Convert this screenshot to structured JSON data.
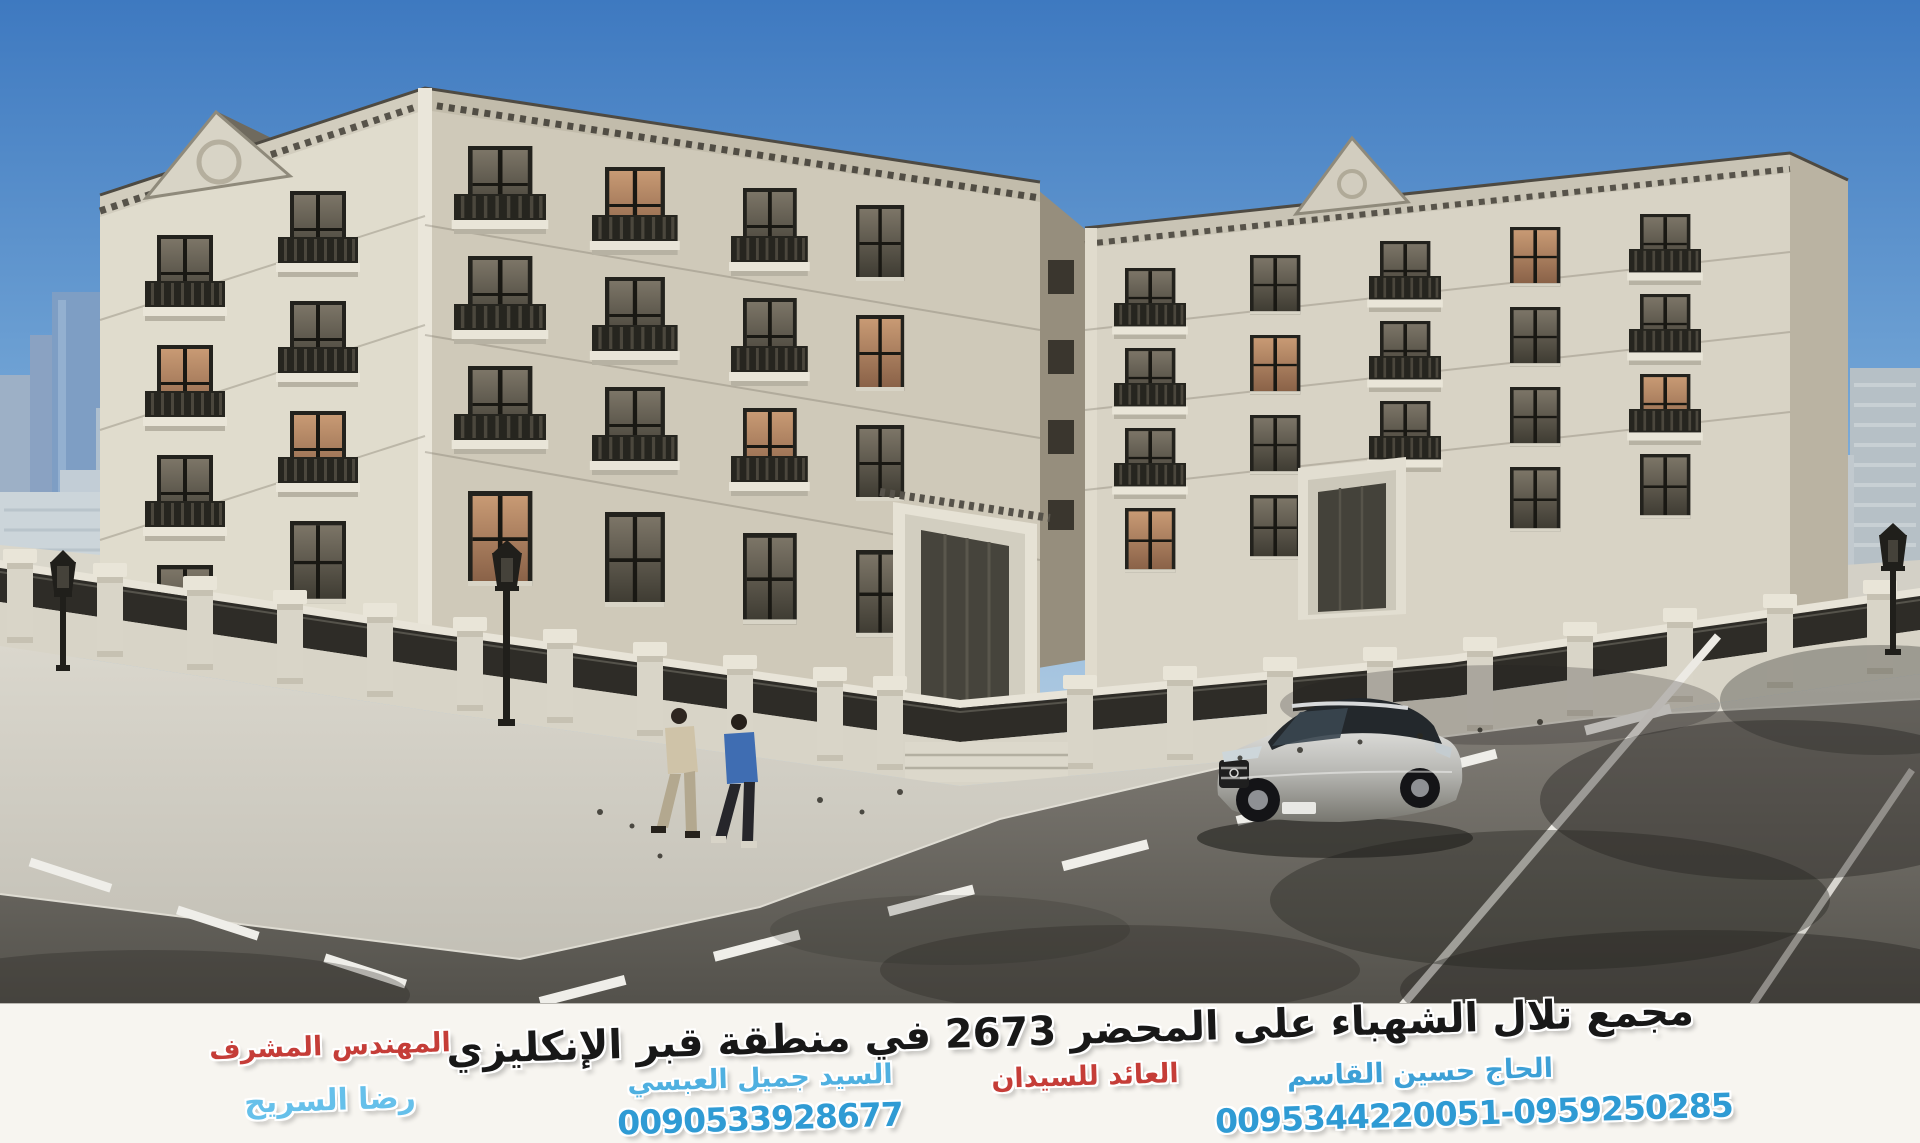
{
  "ad": {
    "headline": "مجمع تلال الشهباء على المحضر 2673 في منطقة قبر الإنكليزي",
    "left_block": {
      "title": "المهندس المشرف",
      "name": "رضا السريح"
    },
    "middle_block": {
      "name": "السيد جميل العبسي",
      "phone": "0090533928677"
    },
    "right_block": {
      "name": "الحاج حسين القاسم",
      "note": "العائد للسيدان",
      "phone": "0095344220051-0959250285"
    }
  },
  "colors": {
    "sky_top": "#3e79c0",
    "sky_horizon": "#dce7ee",
    "building_light": "#e0dccd",
    "building_shade": "#cfc9b9",
    "railing_dark": "#2e2c27",
    "road": "#6e6b65",
    "band_background": "#f7f5f0",
    "headline_text": "#181818",
    "blue_text": "#3da0d6",
    "light_blue_text": "#66c0ea",
    "red_text": "#c53d38",
    "phone_text": "#2f9bd4"
  }
}
